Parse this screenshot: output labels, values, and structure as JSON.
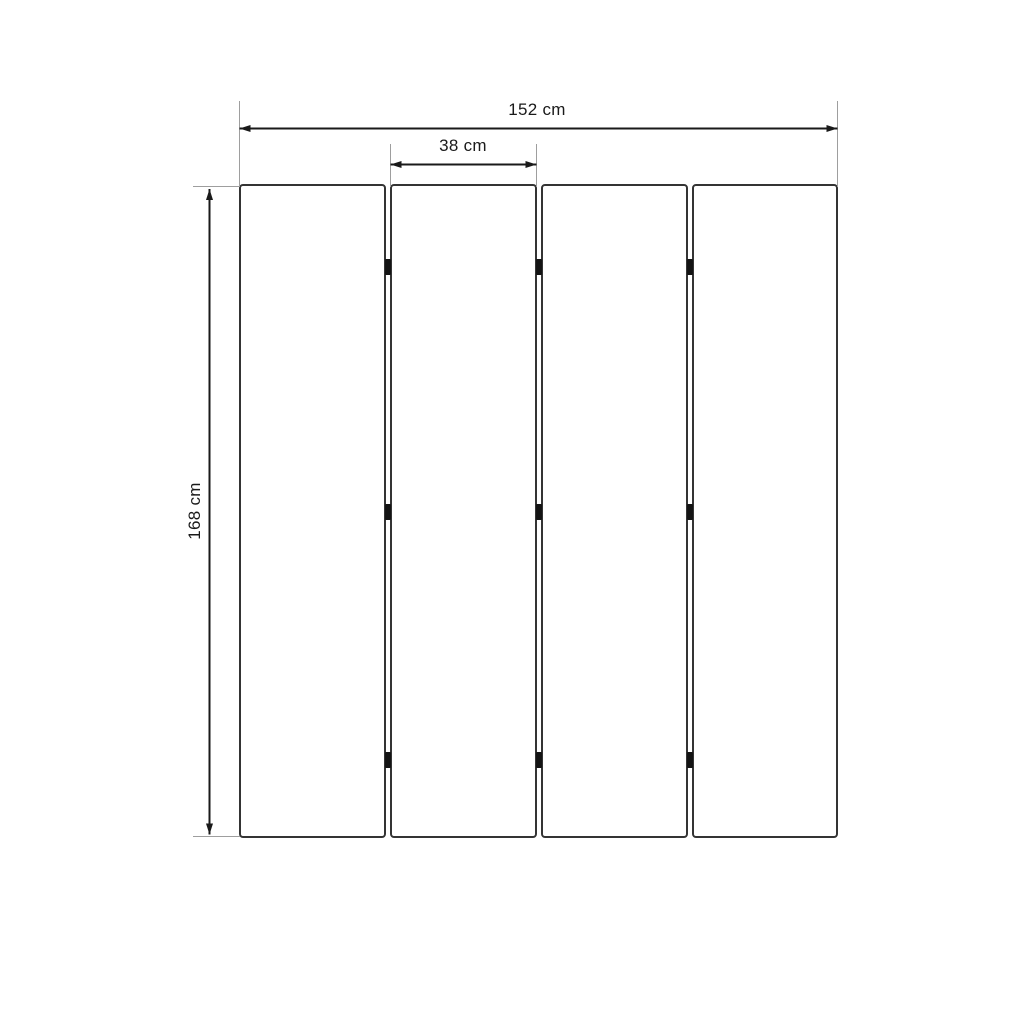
{
  "diagram": {
    "type": "dimension-drawing",
    "subject": "four-panel folding screen, front elevation",
    "panel_count": 4,
    "gap_count": 3,
    "hinges_per_gap": 3,
    "dimensions": {
      "total_width": {
        "label": "152 cm",
        "value": 152,
        "unit": "cm"
      },
      "panel_width": {
        "label": "38 cm",
        "value": 38,
        "unit": "cm"
      },
      "height": {
        "label": "168 cm",
        "value": 168,
        "unit": "cm"
      }
    },
    "colors": {
      "background": "#ffffff",
      "dimension_line": "#1a1a1a",
      "extension_line": "#9e9e9e",
      "panel_border": "#343434",
      "panel_fill": "#ffffff",
      "hinge": "#141414",
      "text": "#1a1a1a"
    }
  }
}
